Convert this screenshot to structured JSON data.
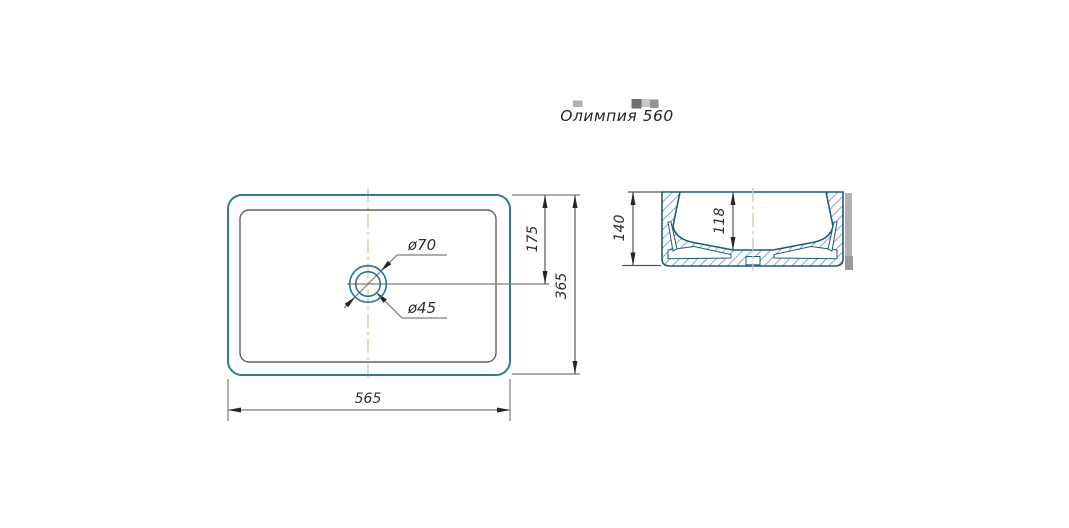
{
  "title": "Олимпия 560",
  "views": {
    "top": {
      "dim_width": "565",
      "dim_height": "365",
      "dim_drain_offset": "175",
      "dim_drain_outer": "ø70",
      "dim_drain_inner": "ø45"
    },
    "side": {
      "dim_height": "140",
      "dim_inner_depth": "118"
    }
  },
  "colors": {
    "outline_teal": "#2a7d99",
    "outline_navy": "#1d5a7d",
    "hatch_blue": "#4e86a6",
    "inner_rim_gray": "#606060",
    "dim_line_gray": "#7d7d7d",
    "arrow_dark": "#262626",
    "centerline_tan": "#cfc8a4",
    "text_dark": "#2e2e2e",
    "shadow_gray": "#b1b1b1"
  }
}
